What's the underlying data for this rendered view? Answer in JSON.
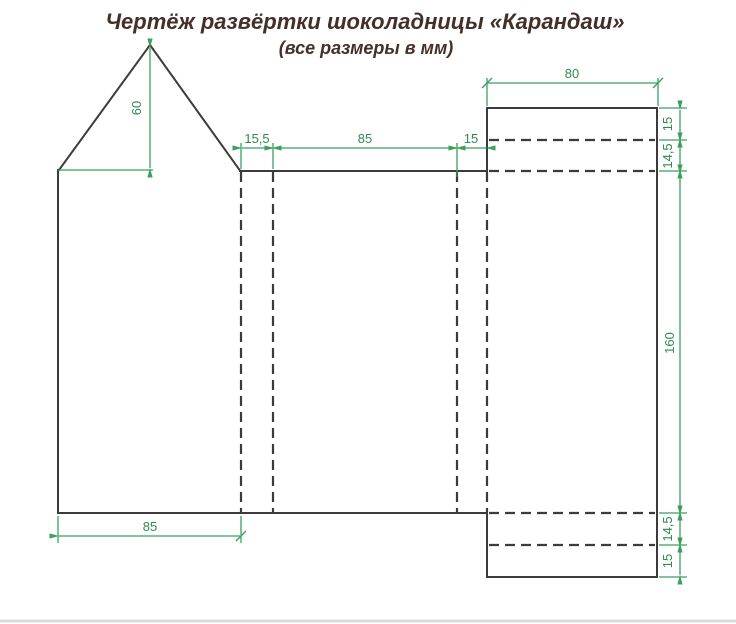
{
  "title": {
    "main": "Чертёж развёртки шоколадницы «Карандаш»",
    "subtitle": "(все размеры в мм)"
  },
  "colors": {
    "outline": "#3b3b3b",
    "dimension": "#3aa05e",
    "dimension_text": "#2f8a4e",
    "title_text": "#44302a",
    "footer_rule": "#dcdcdc",
    "background": "#ffffff"
  },
  "dim_labels": {
    "roof_height": "60",
    "top_flap": "15,5",
    "top_panel": "85",
    "top_glue": "15",
    "lid_width": "80",
    "right_lip_top": "15",
    "right_fold_top": "14,5",
    "side_height": "160",
    "right_fold_bottom": "14,5",
    "right_lip_bottom": "15",
    "bottom_panel": "85"
  }
}
